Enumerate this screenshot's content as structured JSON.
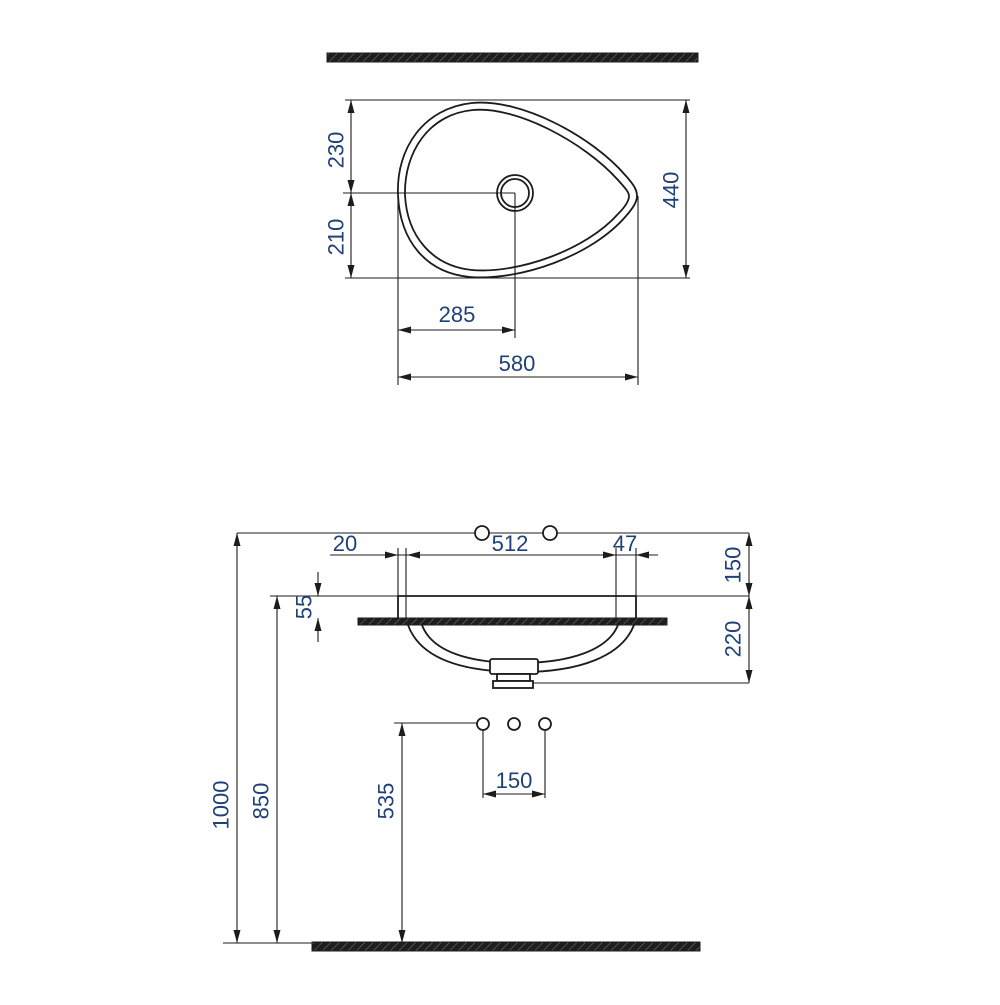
{
  "colors": {
    "dimension_text": "#1f4078",
    "line": "#1c1c1c",
    "background": "#ffffff"
  },
  "plan_view": {
    "overall_width": "580",
    "drain_from_left": "285",
    "overall_depth": "440",
    "drain_from_back": "230",
    "drain_from_front": "210"
  },
  "front_view": {
    "rim_to_cutout_left": "20",
    "cutout_width": "512",
    "cutout_to_rim_right": "47",
    "faucet_above_rim": "150",
    "rim_above_counter": "55",
    "basin_depth_below_rim": "220",
    "faucet_height_from_floor": "1000",
    "rim_height_from_floor": "850",
    "supply_height_from_floor": "535",
    "supply_hole_spacing": "150"
  }
}
